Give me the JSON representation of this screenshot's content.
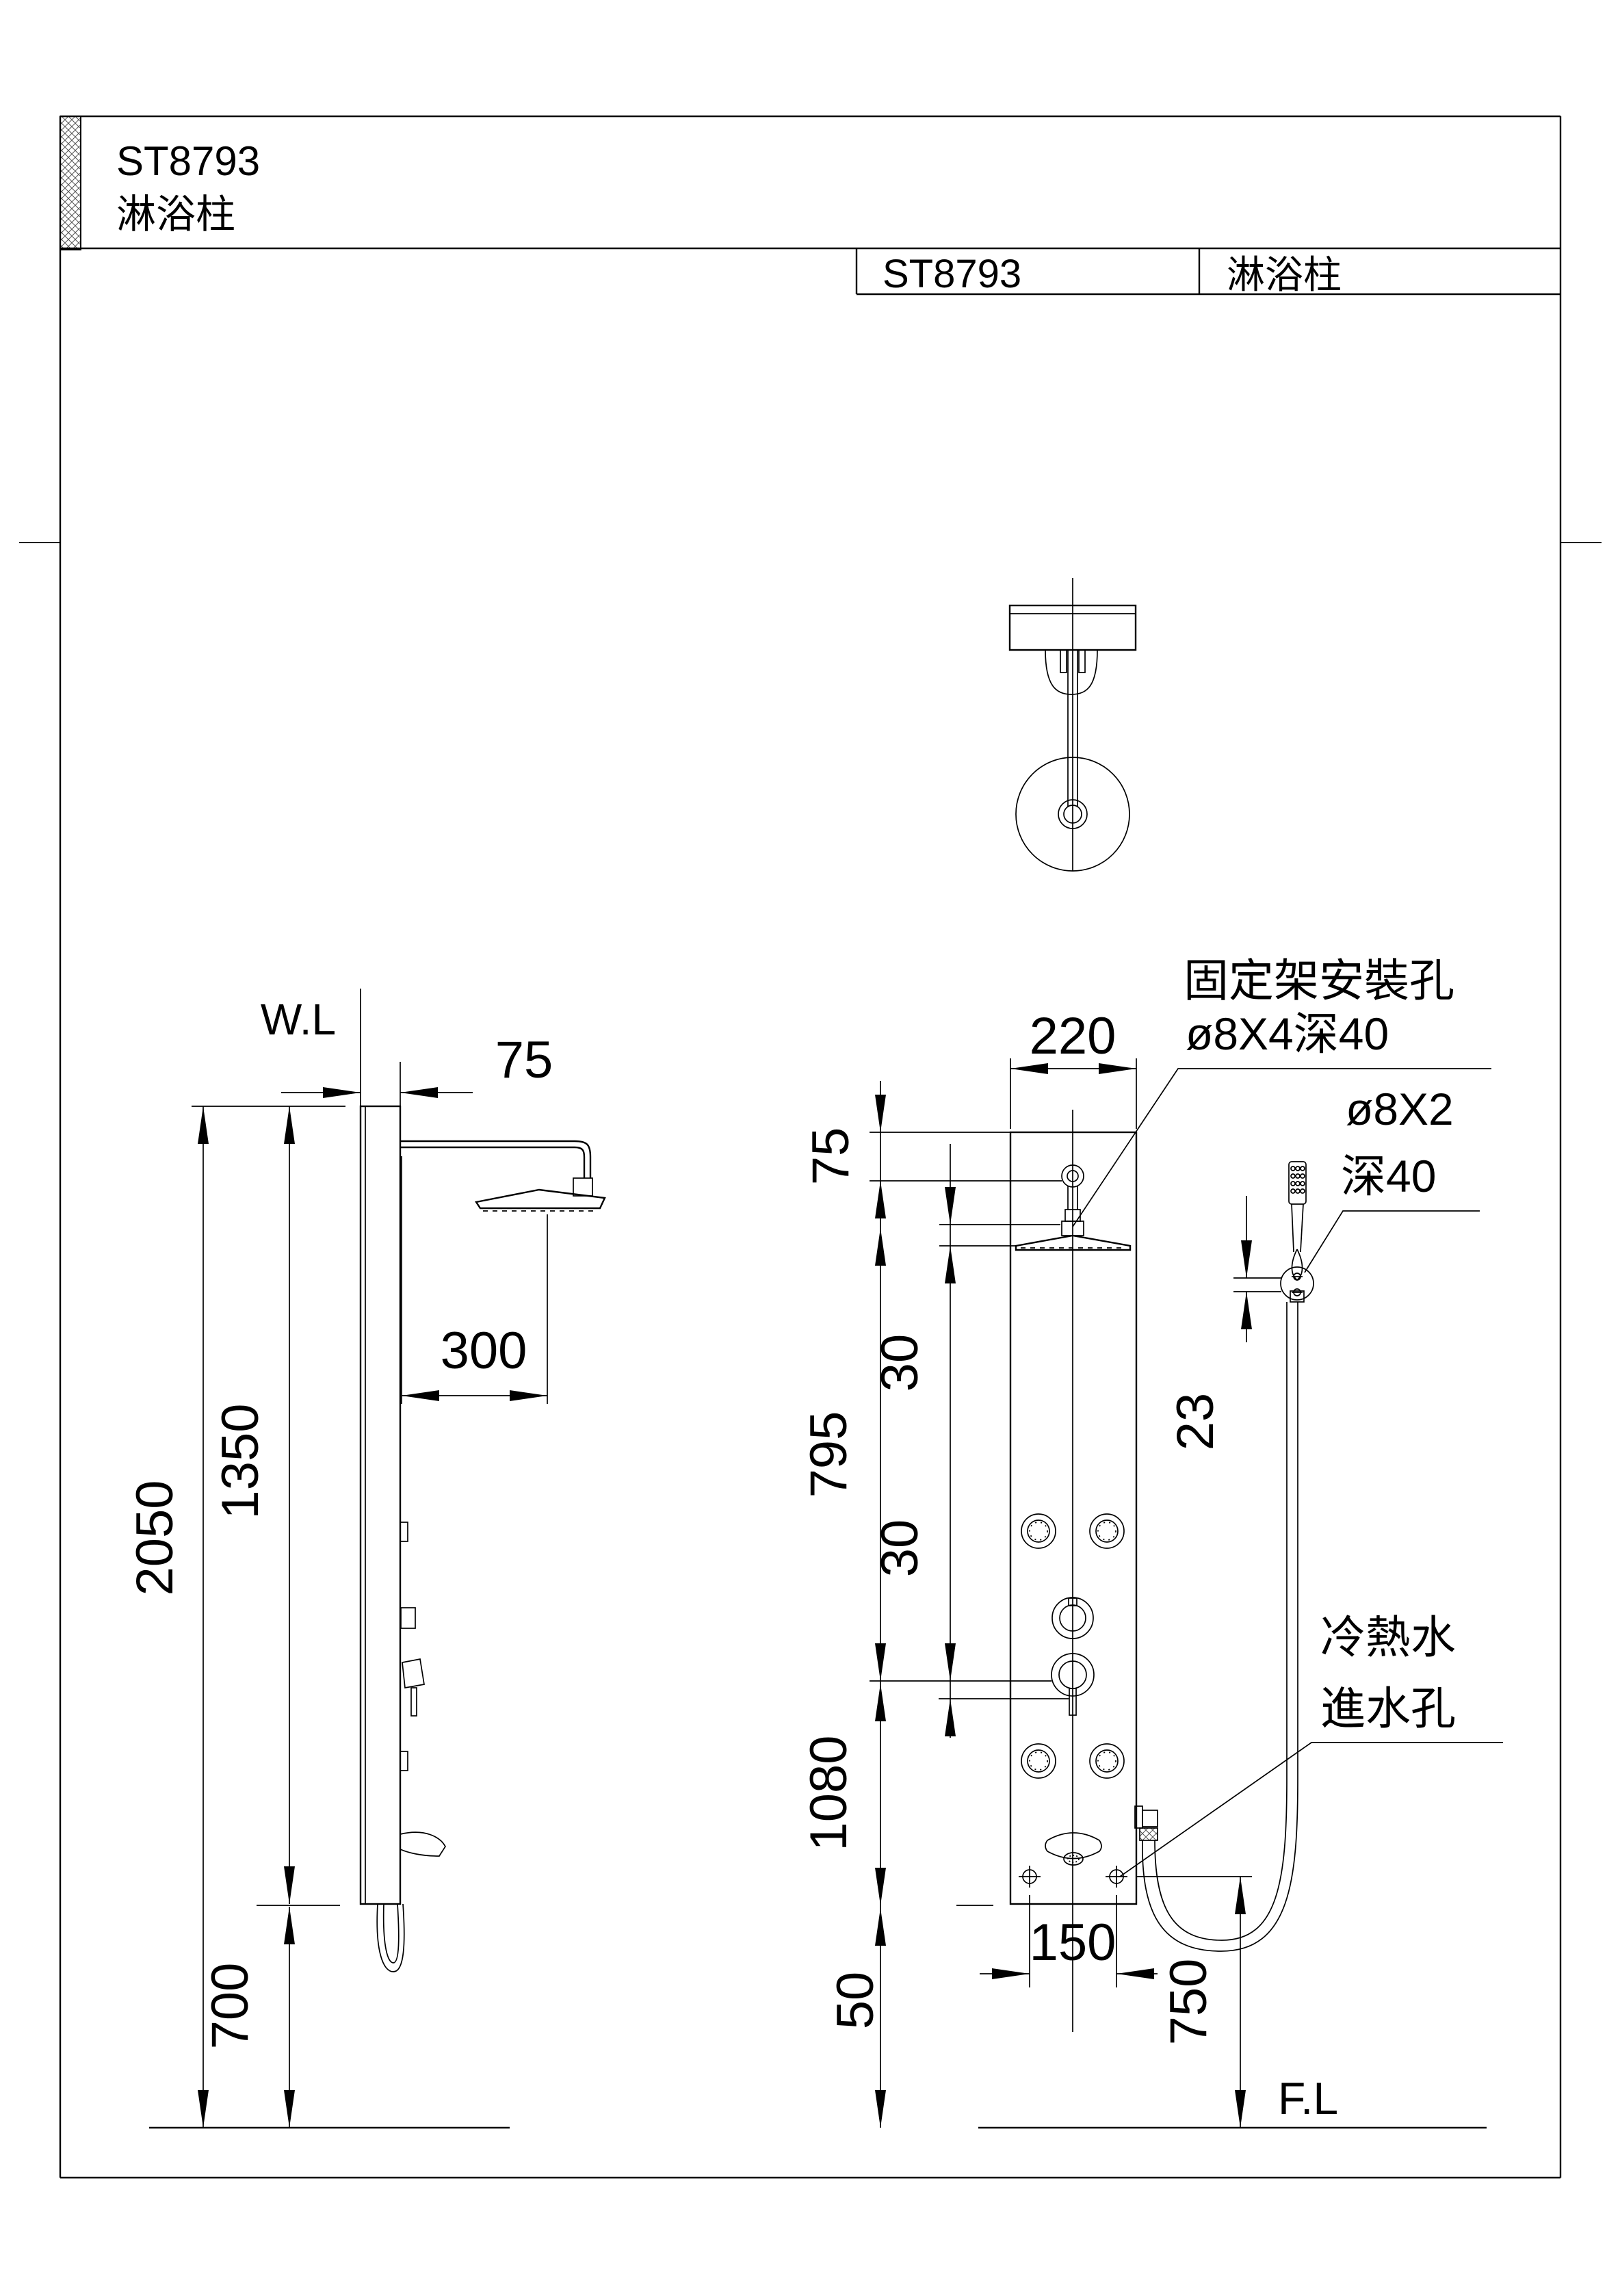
{
  "page": {
    "model": "ST8793",
    "product_name": "淋浴柱",
    "floor_label": "F.L",
    "wall_label": "W.L"
  },
  "header_table": {
    "model": "ST8793",
    "product_name": "淋浴柱"
  },
  "side_view": {
    "dim_wall_offset": "75",
    "dim_arm_reach": "300",
    "dim_panel_height": "1350",
    "dim_total_height": "2050",
    "dim_panel_to_floor": "700"
  },
  "front_view": {
    "dim_panel_width": "220",
    "dim_top_to_hole": "75",
    "dim_hole_gap_upper": "30",
    "dim_hole_gap_lower": "30",
    "dim_upper_span": "795",
    "dim_lower_span": "1080",
    "dim_bottom_margin": "50",
    "dim_inlet_spacing": "150",
    "dim_holder_height": "750",
    "dim_holder_hole_gap": "23"
  },
  "annotations": {
    "bracket_hole_title": "固定架安裝孔",
    "bracket_hole_spec": "ø8X4深40",
    "holder_hole_spec_line1": "ø8X2",
    "holder_hole_spec_line2": "深40",
    "water_inlet_line1": "冷熱水",
    "water_inlet_line2": "進水孔"
  }
}
